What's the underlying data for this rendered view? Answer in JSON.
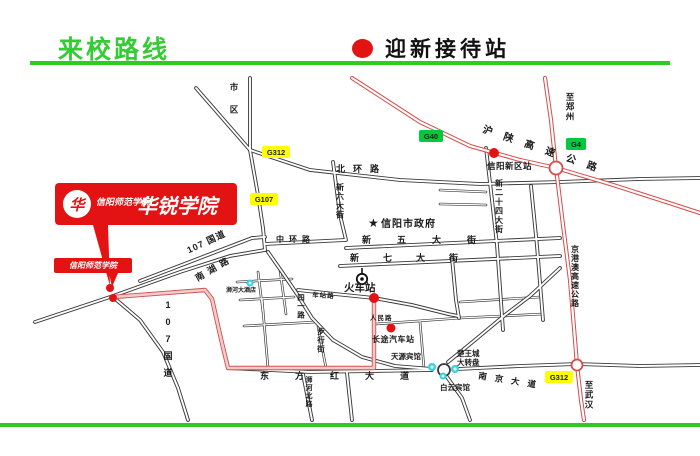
{
  "header": {
    "title": "来校路线",
    "legend": "迎新接待站"
  },
  "college": {
    "name_small": "信阳师范学院",
    "name_large": "华锐学院",
    "callout": "信阳师范学院",
    "logo_glyph": "华"
  },
  "markers": {
    "train_station": "火车站",
    "bus_station": "长途汽车站",
    "new_district_station": "信阳新区站",
    "government": "信阳市政府",
    "government_star": "★",
    "tianyuan_hotel": "天源宾馆",
    "baiyun_hotel": "白云宾馆",
    "chuwangcheng_line1": "楚王城",
    "chuwangcheng_line2": "大转盘",
    "shihe_hotel": "浉河大酒店"
  },
  "roads": {
    "beihuan": "北环路",
    "zhonghuan": "中环路",
    "xinwu": "新五大街",
    "xinqi": "新七大街",
    "xinliu": "新六大街",
    "xin24": "新二十四大街",
    "nanhu": "南湖路",
    "guodao107_ne": "107 国道",
    "guodao107_s": "107国道",
    "siyi": "四一路",
    "buxingjie": "步行街",
    "dongfanghong": "东方红大道",
    "shihebei": "浉河北路",
    "nanjing": "南京大道",
    "chezhan": "车站路",
    "renmin": "人民路",
    "hushaan": "沪陕高速公路",
    "jinggangao": "京港澳高速公路"
  },
  "signs": {
    "g312_nw": "G312",
    "g107": "G107",
    "g40": "G40",
    "g4": "G4",
    "g312_se": "G312"
  },
  "directions": {
    "to_zhengzhou": "至郑州",
    "to_wuhan": "至武汉",
    "to_city": "市区"
  },
  "colors": {
    "accent_green": "#2ecc22",
    "brand_red": "#e31313",
    "yellow_sign": "#ffff00",
    "green_sign": "#00c93c",
    "cyan_marker": "#39d0e0",
    "route_pink": "#f6caca"
  }
}
